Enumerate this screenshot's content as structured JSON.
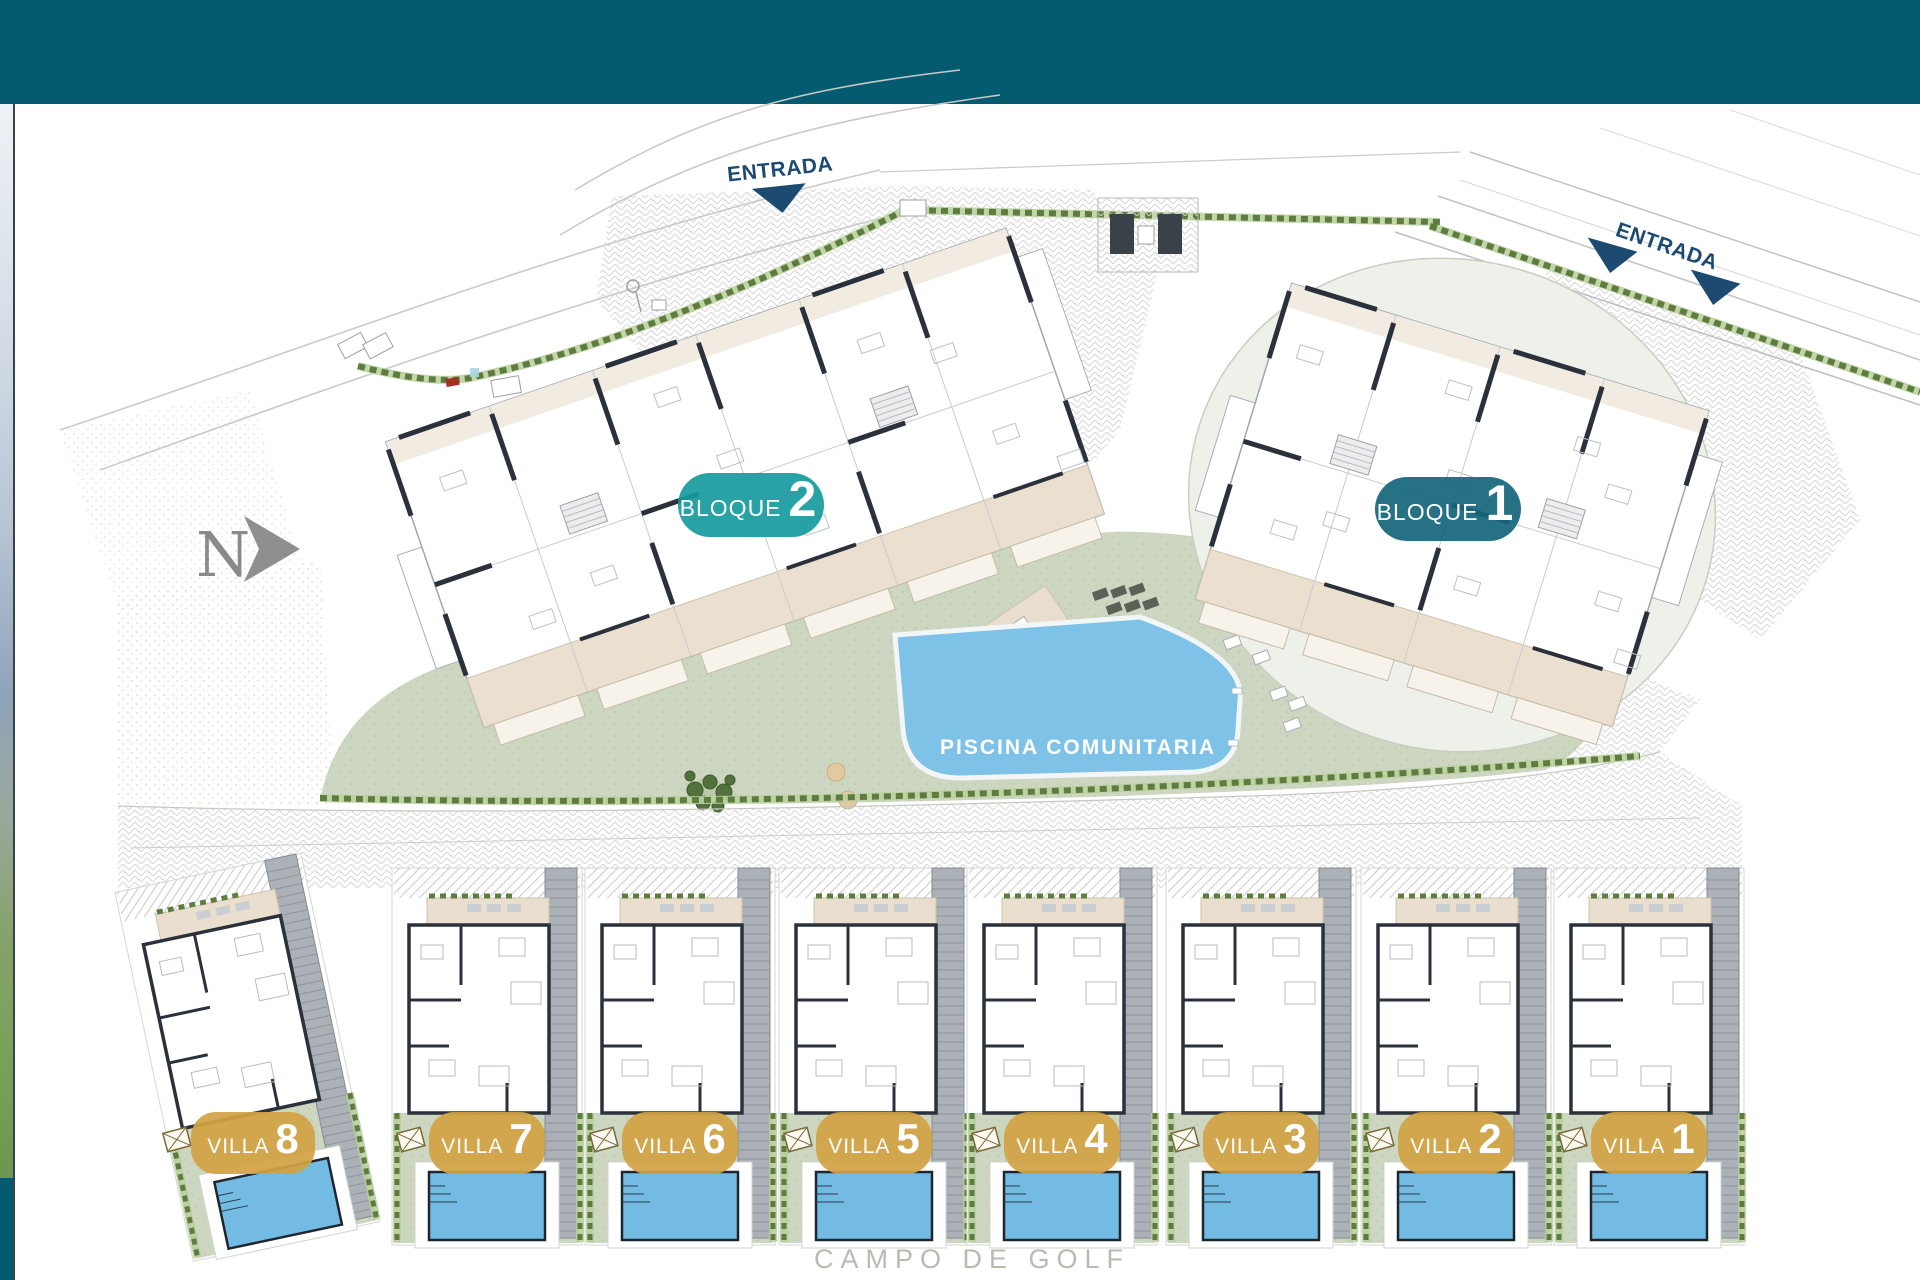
{
  "header": {
    "color": "#045a6e"
  },
  "plan": {
    "north": "N",
    "entrance_labels": [
      "ENTRADA",
      "ENTRADA"
    ],
    "blocks": [
      {
        "label": "BLOQUE",
        "number": "2",
        "badge_color": "#169a9c"
      },
      {
        "label": "BLOQUE",
        "number": "1",
        "badge_color": "#15657b"
      }
    ],
    "pool_label": "PISCINA COMUNITARIA",
    "villas": [
      {
        "label": "VILLA",
        "number": "8"
      },
      {
        "label": "VILLA",
        "number": "7"
      },
      {
        "label": "VILLA",
        "number": "6"
      },
      {
        "label": "VILLA",
        "number": "5"
      },
      {
        "label": "VILLA",
        "number": "4"
      },
      {
        "label": "VILLA",
        "number": "3"
      },
      {
        "label": "VILLA",
        "number": "2"
      },
      {
        "label": "VILLA",
        "number": "1"
      }
    ],
    "villa_badge_color": "#d2a344",
    "golf_label": "CAMPO DE GOLF",
    "colors": {
      "entrance_navy": "#1c4a70",
      "pool_blue": "#7fc2e8",
      "lawn_green": "#ccd6c1",
      "hedge_green": "#5d7d3f",
      "golf_text_gray": "#b6bcb0",
      "north_gray": "#8a8a8a"
    }
  }
}
